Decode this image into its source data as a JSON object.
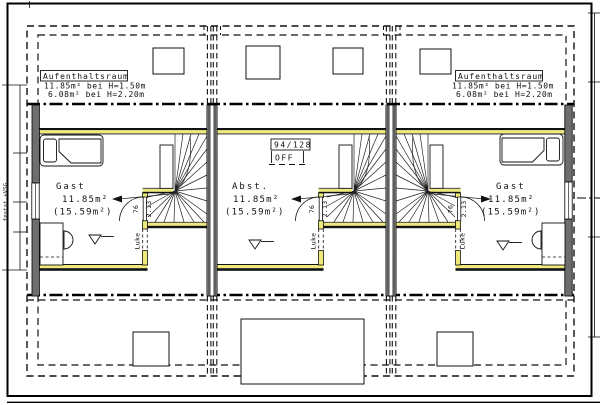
{
  "drawing_type": "floor-plan",
  "colors": {
    "insulation_yellow": "#efe97a",
    "wall_gray": "#6e6e6e",
    "line_black": "#111111",
    "paper_white": "#ffffff"
  },
  "roof_space_label": {
    "title": "Aufenthaltsraum",
    "line1": "11.85m² bei H=1.50m",
    "line2": "6.08m² bei H=2.20m"
  },
  "rooms": {
    "left": {
      "name": "Gast",
      "area": "11.85m²",
      "gross_area": "(15.59m²)"
    },
    "middle": {
      "name": "Abst.",
      "area": "11.85m²",
      "gross_area": "(15.59m²)"
    },
    "right": {
      "name": "Gast",
      "area": "11.85m²",
      "gross_area": "(15.59m²)"
    }
  },
  "roof_window_tag": {
    "size": "94/128",
    "state": "OFF"
  },
  "door_dimensions": {
    "width": "76",
    "height": "2.13"
  },
  "hatch_label": "Luke",
  "glazing_label": "festst.+VSG"
}
